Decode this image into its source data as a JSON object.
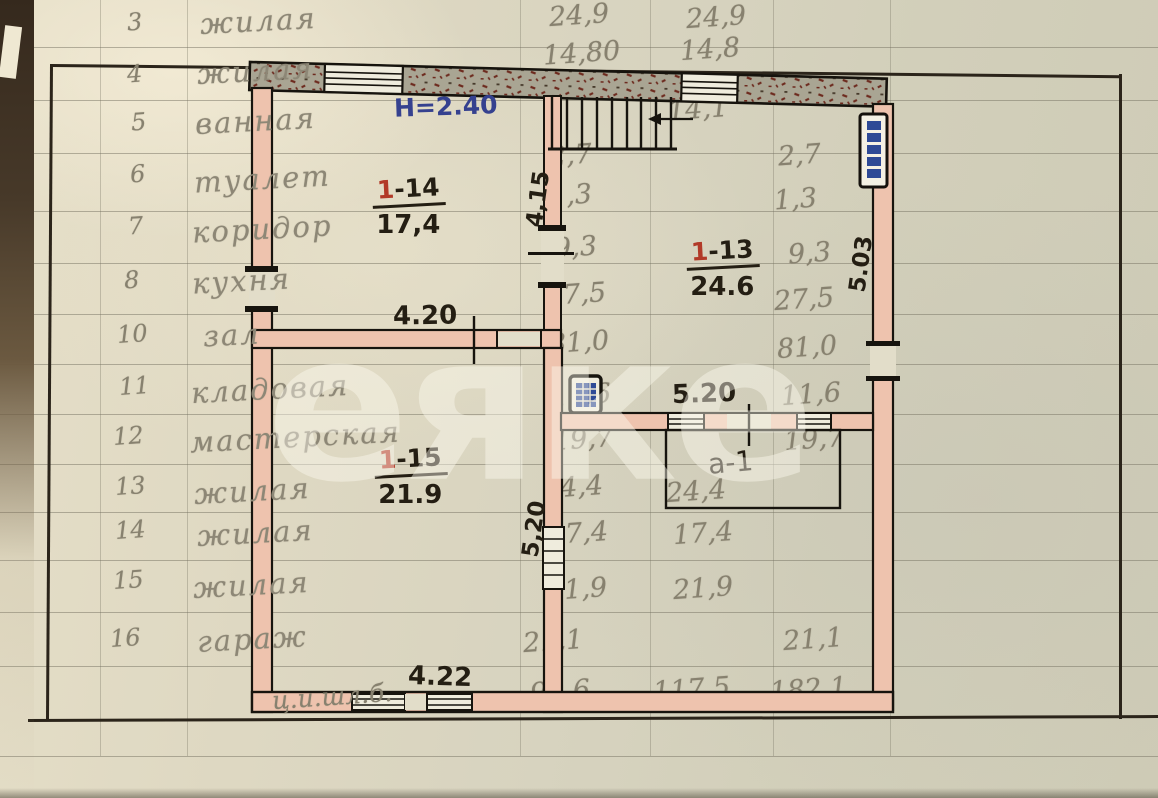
{
  "page": {
    "watermark": "еяке"
  },
  "colors": {
    "paper": "#d8d3bf",
    "wall_fill_pink": "#eec3ae",
    "wall_hatch_gray": "#a9a593",
    "ink_black": "#241e13",
    "ink_blue": "#35418f",
    "ink_red": "#b23a28",
    "pencil_gray": "#87816f",
    "radiator_blue": "#2e4a96"
  },
  "ledger": {
    "rows": [
      {
        "num": "3",
        "label": "жилая"
      },
      {
        "num": "4",
        "label": "жилая"
      },
      {
        "num": "5",
        "label": "ванная"
      },
      {
        "num": "6",
        "label": "туалет"
      },
      {
        "num": "7",
        "label": "коридор"
      },
      {
        "num": "8",
        "label": "кухня"
      },
      {
        "num": "10",
        "label": "зал"
      },
      {
        "num": "11",
        "label": "кладовая"
      },
      {
        "num": "12",
        "label": "мастерская"
      },
      {
        "num": "13",
        "label": "жилая"
      },
      {
        "num": "14",
        "label": "жилая"
      },
      {
        "num": "15",
        "label": "жилая"
      },
      {
        "num": "16",
        "label": "гараж"
      }
    ],
    "totals": [
      "99,6",
      "117,5",
      "182,1"
    ],
    "material_note": "ц.и.шл.б."
  },
  "plan": {
    "height_note": "Н=2.40",
    "rooms": [
      {
        "prefix": "1",
        "suffix": "-14",
        "area": "17,4"
      },
      {
        "prefix": "1",
        "suffix": "-13",
        "area": "24.6"
      },
      {
        "prefix": "1",
        "suffix": "-15",
        "area": "21.9"
      },
      {
        "id": "а-1"
      }
    ],
    "dims": {
      "d415": "4,15",
      "d420": "4.20",
      "d520": "5.20",
      "d520v": "5,20",
      "d503": "5.03",
      "d422": "4.22"
    },
    "icons": {
      "radiator": "radiator-icon",
      "stove": "stove-icon",
      "stairs": "staircase",
      "windows": "window-symbol"
    }
  },
  "measurements": {
    "stair": "14,1",
    "pairs": [
      {
        "left": "24,9",
        "right": "24,9"
      },
      {
        "left": "14,80",
        "right": "14,8"
      },
      {
        "left": "2,7",
        "right": "2,7"
      },
      {
        "left": "1,3",
        "right": "1,3"
      },
      {
        "left": "9,3",
        "right": "9,3"
      },
      {
        "left": "27,5",
        "right": "27,5"
      },
      {
        "left": "81,0",
        "right": "81,0"
      },
      {
        "left": "11,6",
        "right": "11,6"
      },
      {
        "left": "19,7",
        "right": "19,7"
      },
      {
        "left": "24,4",
        "right": "24,4"
      },
      {
        "left": "17,4",
        "right": "17,4"
      },
      {
        "left": "21,9",
        "right": "21,9"
      },
      {
        "left": "21,1",
        "right": "21,1"
      }
    ]
  }
}
